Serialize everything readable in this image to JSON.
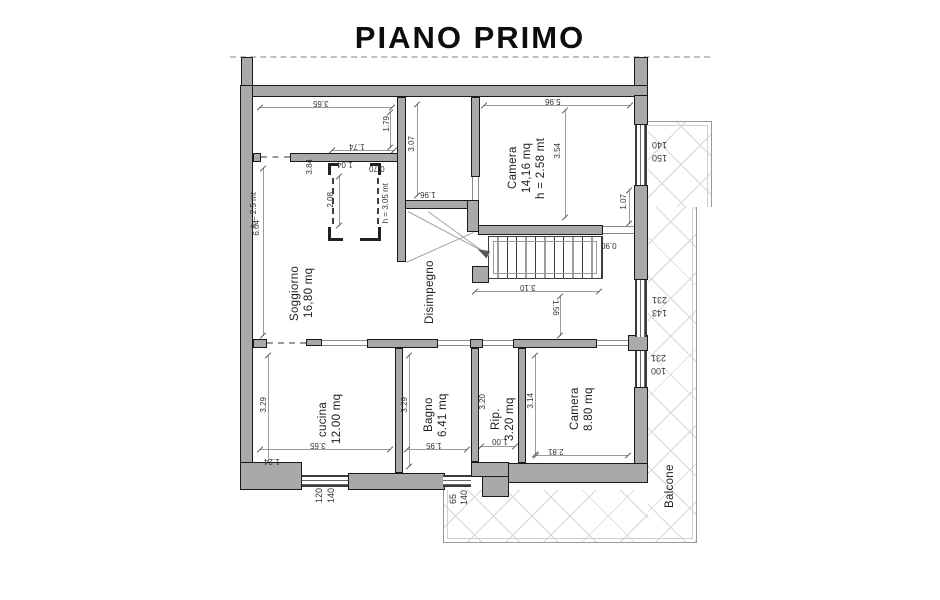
{
  "title": "PIANO PRIMO",
  "rooms": {
    "soggiorno": {
      "name": "Soggiorno",
      "area": "16,80 mq"
    },
    "disimpegno": {
      "name": "Disimpegno"
    },
    "camera1": {
      "name": "Camera",
      "area": "14,16 mq",
      "height": "h = 2.58 mt"
    },
    "cucina": {
      "name": "cucina",
      "area": "12.00 mq"
    },
    "bagno": {
      "name": "Bagno",
      "area": "6.41 mq"
    },
    "rip": {
      "name": "Rip.",
      "area": "3.20 mq"
    },
    "camera2": {
      "name": "Camera",
      "area": "8.80 mq"
    },
    "balcone": {
      "name": "Balcone"
    }
  },
  "heights": {
    "disimpegno": "h = 3.05 mt",
    "soggiorno": "h = 2.5 mt"
  },
  "dims": {
    "top_room_width": "3.65",
    "top_room_depth": "1.79",
    "wall_seg": "1.74",
    "niche_w": "1.04",
    "niche_side": "0.70",
    "niche_d": "2.08",
    "niche_wall": "3.84",
    "mid_depth": "3.07",
    "mid_width": "1.96",
    "camera1_width": "5.96",
    "camera1_depth": "3.54",
    "camera1_side": "1.07",
    "stair_door": "0.90",
    "stair_len": "3.10",
    "stair_off": "1.56",
    "left_wall": "6.04",
    "cucina_depth": "3.29",
    "cucina_width": "3.65",
    "cucina_corner": "1.24",
    "bagno_depth": "3.29",
    "bagno_width": "1.95",
    "rip_depth": "3.20",
    "rip_width": "1.00",
    "camera2_depth": "3.14",
    "camera2_width": "2.81"
  },
  "windows": {
    "w1": {
      "a": "140",
      "b": "150"
    },
    "w2": {
      "a": "231",
      "b": "143"
    },
    "w3": {
      "a": "231",
      "b": "100"
    },
    "w4": {
      "a": "120",
      "b": "140"
    },
    "w5": {
      "a": "65",
      "b": "140"
    }
  },
  "colors": {
    "wall_fill": "#a9a9a9",
    "wall_edge": "#1a1a1a",
    "hatch": "#d6d6d6"
  }
}
